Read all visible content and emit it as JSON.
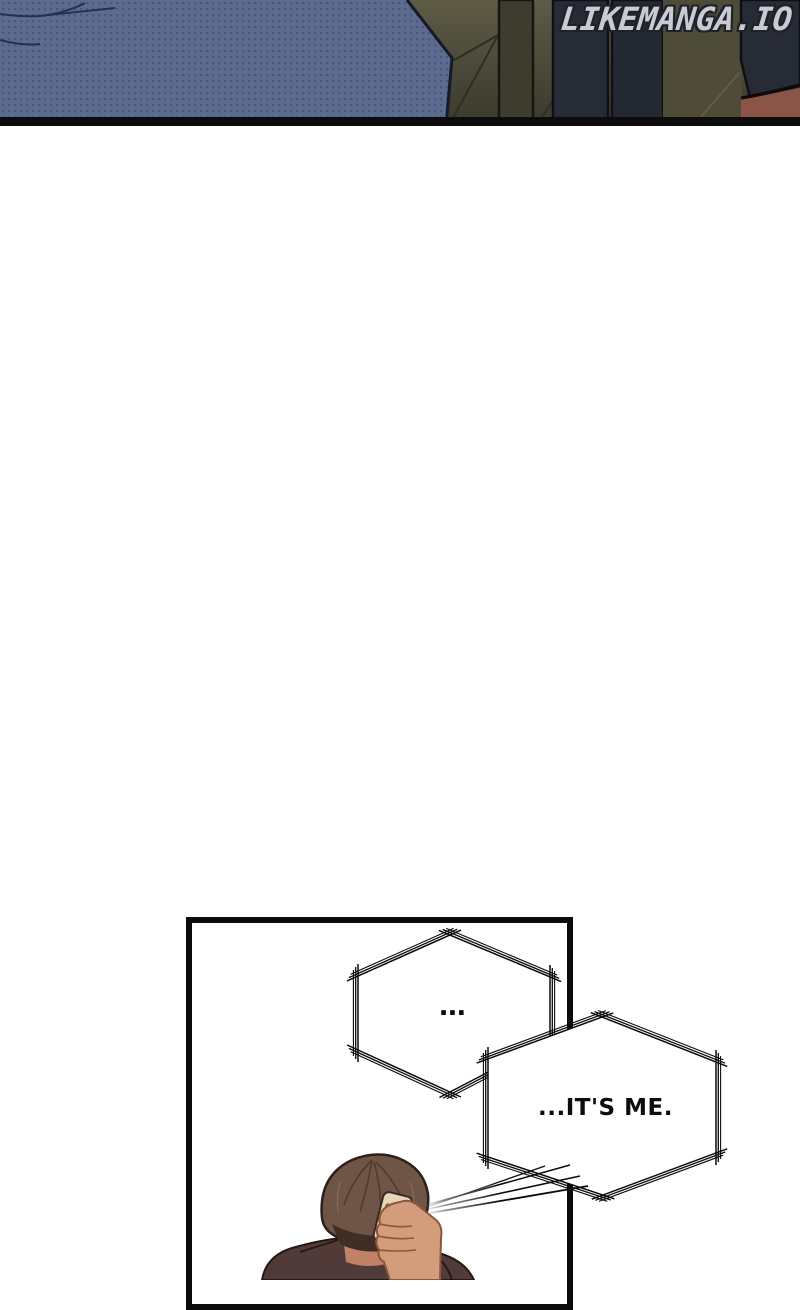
{
  "watermark": {
    "text": "LIKEMANGA.IO"
  },
  "top_panel": {
    "description": "dark bedroom scene: corner of dotted bed, tiled floor, legs of standing figures",
    "colors": {
      "bed": "#5d6c8e",
      "bed_dot": "#49587c",
      "floor": "#55523e",
      "floor_line": "#2f2e25",
      "figure_dark": "#262a34",
      "skin": "#8a5547",
      "panel_border": "#0c0c0c"
    }
  },
  "bottom_panel": {
    "description": "panel of man seen from behind holding a phone to his ear, two sketchy hexagonal speech bubbles",
    "bubbles": [
      {
        "text": "..."
      },
      {
        "text": "...IT'S ME."
      }
    ],
    "character": {
      "colors": {
        "hair": "#6f5546",
        "hair_dark": "#3f2d26",
        "skin": "#d39c7a",
        "phone": "#e7d5b9",
        "jacket": "#503b38"
      }
    }
  }
}
